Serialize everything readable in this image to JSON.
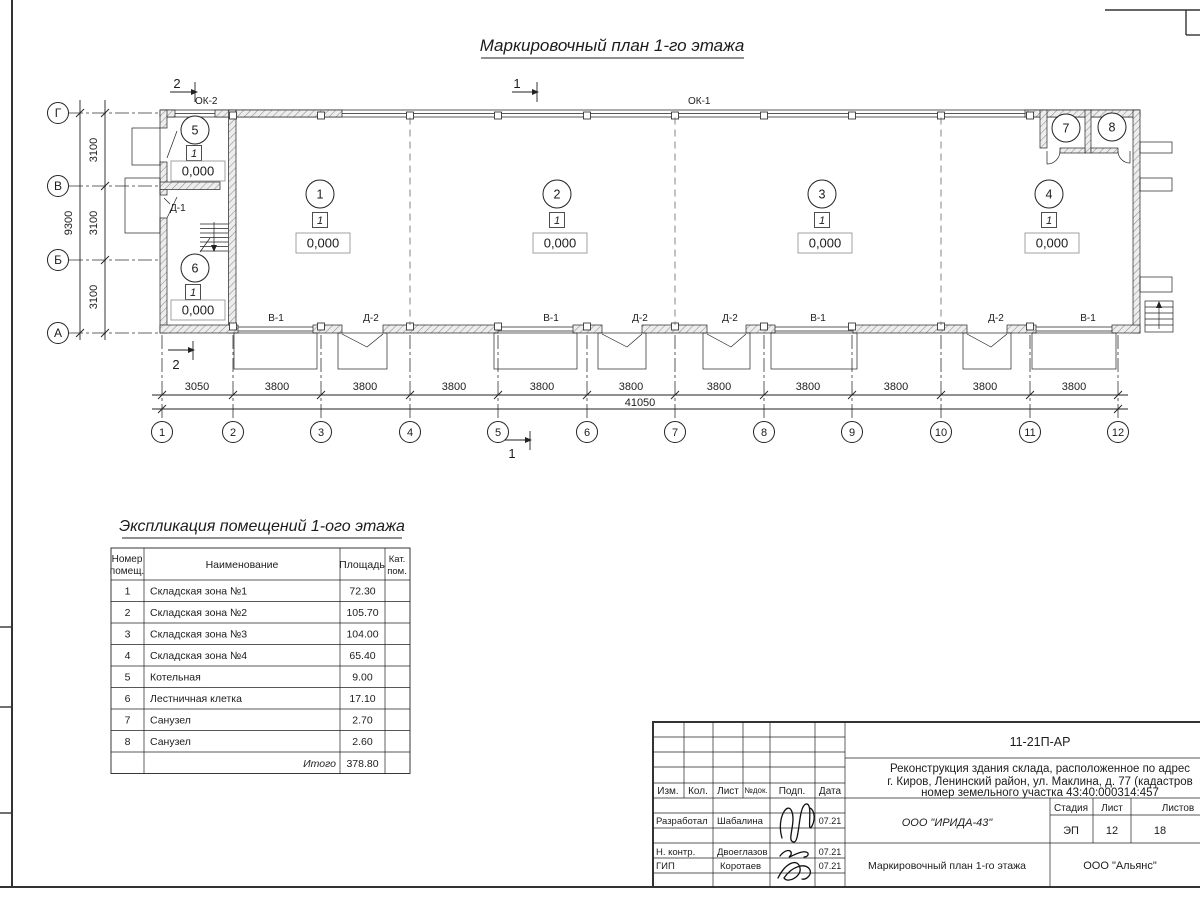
{
  "plan": {
    "title": "Маркировочный план 1-го этажа",
    "marks": {
      "sec1": "1",
      "sec2": "2"
    },
    "windows": {
      "ok1": "ОК-1",
      "ok2": "ОК-2"
    },
    "door_d1": "Д-1",
    "bottom_labels": [
      "В-1",
      "Д-2",
      "В-1",
      "Д-2",
      "Д-2",
      "В-1",
      "Д-2",
      "В-1"
    ],
    "rooms": [
      {
        "num": "1",
        "cat": "1",
        "elev": "0,000"
      },
      {
        "num": "2",
        "cat": "1",
        "elev": "0,000"
      },
      {
        "num": "3",
        "cat": "1",
        "elev": "0,000"
      },
      {
        "num": "4",
        "cat": "1",
        "elev": "0,000"
      },
      {
        "num": "5",
        "cat": "1",
        "elev": "0,000"
      },
      {
        "num": "6",
        "cat": "1",
        "elev": "0,000"
      },
      {
        "num": "7"
      },
      {
        "num": "8"
      }
    ],
    "axes_rows": [
      "Г",
      "В",
      "Б",
      "А"
    ],
    "axes_cols": [
      "1",
      "2",
      "3",
      "4",
      "5",
      "6",
      "7",
      "8",
      "9",
      "10",
      "11",
      "12"
    ],
    "dims": {
      "spans": [
        "3050",
        "3800",
        "3800",
        "3800",
        "3800",
        "3800",
        "3800",
        "3800",
        "3800",
        "3800",
        "3800"
      ],
      "total": "41050",
      "left_spans": [
        "3100",
        "3100",
        "3100"
      ],
      "left_total": "9300"
    }
  },
  "explication": {
    "title": "Экспликация помещений 1-ого этажа",
    "headers": {
      "num1": "Номер",
      "num2": "помещ.",
      "name": "Наименование",
      "area": "Площадь",
      "cat1": "Кат.",
      "cat2": "пом."
    },
    "rows": [
      {
        "n": "1",
        "name": "Складская зона №1",
        "area": "72.30"
      },
      {
        "n": "2",
        "name": "Складская зона №2",
        "area": "105.70"
      },
      {
        "n": "3",
        "name": "Складская зона №3",
        "area": "104.00"
      },
      {
        "n": "4",
        "name": "Складская зона №4",
        "area": "65.40"
      },
      {
        "n": "5",
        "name": "Котельная",
        "area": "9.00"
      },
      {
        "n": "6",
        "name": "Лестничная клетка",
        "area": "17.10"
      },
      {
        "n": "7",
        "name": "Санузел",
        "area": "2.70"
      },
      {
        "n": "8",
        "name": "Санузел",
        "area": "2.60"
      }
    ],
    "total_label": "Итого",
    "total_area": "378.80"
  },
  "stamp": {
    "doc_code": "11-21П-АР",
    "project_line1": "Реконструкция здания склада, расположенное по адрес",
    "project_line2": "г. Киров, Ленинский район, ул. Маклина, д. 77 (кадастров",
    "project_line3": "номер земельного участка 43:40:000314:457",
    "cols": {
      "izm": "Изм.",
      "kol": "Кол.",
      "list": "Лист",
      "ndok": "№док.",
      "podp": "Подп.",
      "data": "Дата"
    },
    "rows": [
      {
        "role": "Разработал",
        "name": "Шабалина",
        "date": "07.21"
      },
      {
        "role": "Н. контр.",
        "name": "Двоеглазов",
        "date": "07.21"
      },
      {
        "role": "ГИП",
        "name": "Коротаев",
        "date": "07.21"
      }
    ],
    "org": "ООО \"ИРИДА-43\"",
    "sheet_title": "Маркировочный план 1-го этажа",
    "client": "ООО \"Альянс\"",
    "stage_label": "Стадия",
    "sheet_label": "Лист",
    "sheets_label": "Листов",
    "stage": "ЭП",
    "sheet_no": "12",
    "sheets_total": "18"
  }
}
